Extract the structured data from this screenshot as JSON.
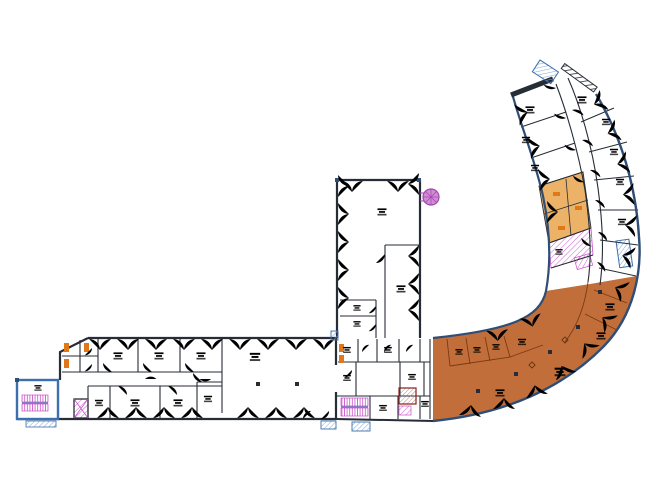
{
  "document": {
    "kind": "architectural floor plan, curved J-shaped building, one level",
    "highlighted_zone_present": true
  },
  "colors": {
    "wall": "#262d36",
    "wallBlue": "#2e4e76",
    "window": "#9cc8df",
    "door": "#d2685f",
    "doorOrange": "#e0831f",
    "orange": "#c16e3a",
    "orangeLine": "#7a3a12",
    "tan": "#ecb267",
    "fixture": "#e07818",
    "magenta": "#c94ec9",
    "purple": "#a346ae",
    "purpleFill": "#d08cd4",
    "blue": "#3b6fae",
    "blueLight": "#7fa8d4",
    "label": "#3a3f46",
    "paper": "#ffffff"
  },
  "legend_semantics": {
    "orange_fill": "highlighted open space / selected tenancy area",
    "magenta_hatch": "staircases and elevator cores",
    "purple_circle": "spiral stair",
    "blue_hatch": "exterior steps / entry platforms",
    "light_blue_arcs": "window and facade door swings",
    "salmon_arcs": "interior door swings",
    "tan_cells": "sanitary / WC rooms"
  }
}
